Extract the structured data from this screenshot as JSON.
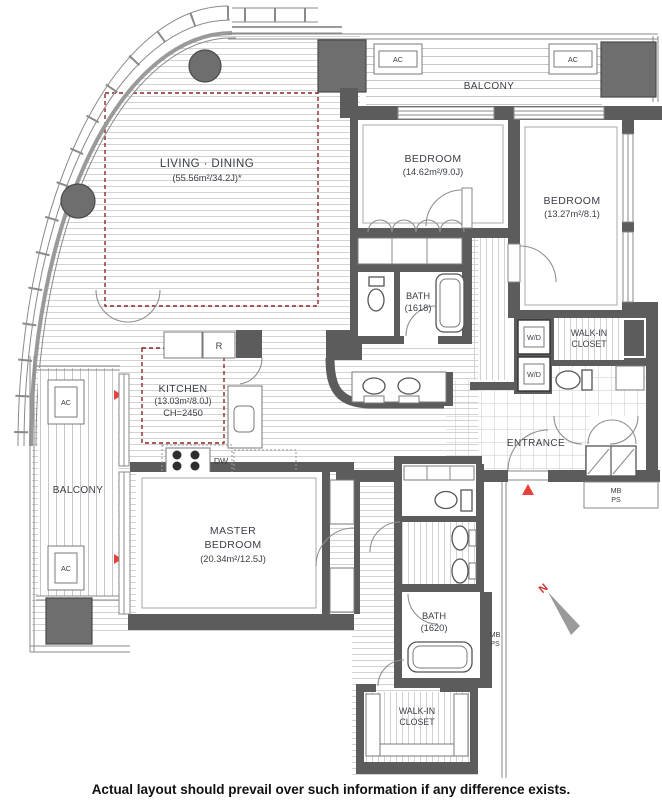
{
  "page": {
    "caption": "Actual layout should prevail over such information if any difference exists."
  },
  "rooms": {
    "living_dining": {
      "name": "LIVING · DINING",
      "area": "(55.56m²/34.2J)*"
    },
    "bedroom_a": {
      "name": "BEDROOM",
      "area": "(14.62m²/9.0J)"
    },
    "bedroom_b": {
      "name": "BEDROOM",
      "area": "(13.27m²/8.1)"
    },
    "kitchen": {
      "name": "KITCHEN",
      "area": "(13.03m²/8.0J)",
      "ceiling_height": "CH=2450"
    },
    "master_bedroom": {
      "name_line1": "MASTER",
      "name_line2": "BEDROOM",
      "area": "(20.34m²/12.5J)"
    },
    "bath_a": {
      "name": "BATH",
      "size": "(1618)"
    },
    "bath_b": {
      "name": "BATH",
      "size": "(1620)"
    },
    "walk_in_closet_a": {
      "line1": "WALK-IN",
      "line2": "CLOSET"
    },
    "walk_in_closet_b": {
      "line1": "WALK-IN",
      "line2": "CLOSET"
    },
    "balcony_top": {
      "name": "BALCONY"
    },
    "balcony_left": {
      "name": "BALCONY"
    },
    "entrance": {
      "name": "ENTRANCE"
    }
  },
  "equipment": {
    "ac": "AC",
    "washer_dryer": "W/D",
    "refrigerator": "R",
    "dishwasher": "DW"
  },
  "shafts": {
    "mb": "MB",
    "ps": "PS"
  },
  "compass": {
    "north": "N"
  },
  "colors": {
    "wall": "#5c5c5c",
    "red_marker": "#e8403a",
    "red_dashed": "#8e2727",
    "label_text": "#3b4047",
    "floor_line": "#d2d2d2"
  }
}
